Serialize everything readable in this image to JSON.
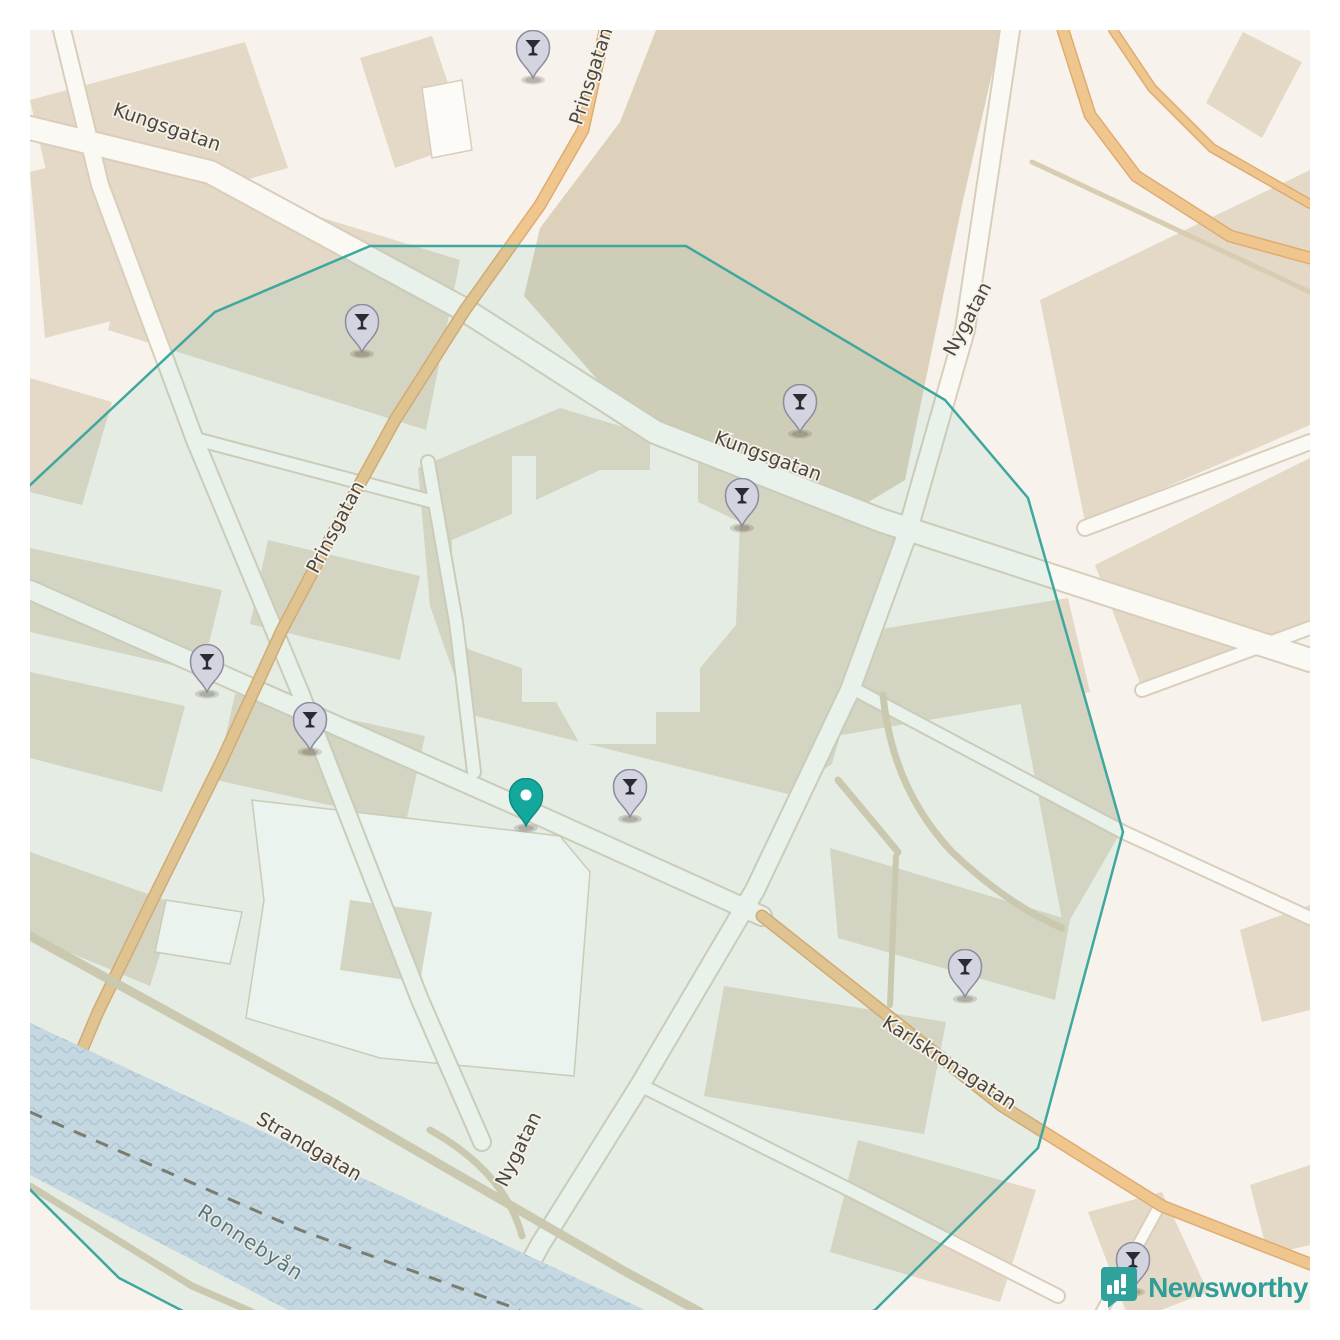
{
  "branding": {
    "logo_text": "Newsworthy",
    "logo_color": "#2f9e96",
    "logo_icon": "bar-chart-exclamation-badge"
  },
  "map": {
    "place": "Ronneby town centre",
    "street_labels": [
      {
        "text": "Kungsgatan",
        "x": 165,
        "y": 133,
        "rotation": 19,
        "kind": "street"
      },
      {
        "text": "Prinsgatan",
        "x": 597,
        "y": 78,
        "rotation": -72,
        "kind": "street"
      },
      {
        "text": "Prinsgatan",
        "x": 341,
        "y": 530,
        "rotation": -62,
        "kind": "street"
      },
      {
        "text": "Kungsgatan",
        "x": 766,
        "y": 462,
        "rotation": 20,
        "kind": "street"
      },
      {
        "text": "Nygatan",
        "x": 973,
        "y": 322,
        "rotation": -62,
        "kind": "street"
      },
      {
        "text": "Nygatan",
        "x": 524,
        "y": 1152,
        "rotation": -64,
        "kind": "street"
      },
      {
        "text": "Strandgatan",
        "x": 306,
        "y": 1152,
        "rotation": 30,
        "kind": "street"
      },
      {
        "text": "Karlskronagatan",
        "x": 946,
        "y": 1068,
        "rotation": 33,
        "kind": "street"
      },
      {
        "text": "Ronnebyån",
        "x": 247,
        "y": 1248,
        "rotation": 33,
        "kind": "water"
      }
    ],
    "markers": [
      {
        "type": "cocktail",
        "x": 533,
        "y": 78
      },
      {
        "type": "cocktail",
        "x": 362,
        "y": 352
      },
      {
        "type": "cocktail",
        "x": 800,
        "y": 432
      },
      {
        "type": "cocktail",
        "x": 742,
        "y": 526
      },
      {
        "type": "cocktail",
        "x": 207,
        "y": 692
      },
      {
        "type": "cocktail",
        "x": 310,
        "y": 750
      },
      {
        "type": "cocktail",
        "x": 630,
        "y": 817
      },
      {
        "type": "cocktail",
        "x": 965,
        "y": 997
      },
      {
        "type": "cocktail",
        "x": 1133,
        "y": 1290
      },
      {
        "type": "center",
        "x": 526,
        "y": 826
      }
    ],
    "marker_colors": {
      "cocktail_fill": "#d4d4e0",
      "cocktail_stroke": "#8c8c9e",
      "cocktail_glyph": "#2b2b33",
      "center_fill": "#14a79b",
      "center_stroke": "#0b8e84"
    },
    "area_polygon": {
      "points": "370,246 686,246 945,400 1028,498 1123,832 1038,1148 875,1310 700,1390 500,1405 300,1370 177,1308 119,1278 -40,1120 -90,840 -50,560 215,312",
      "stroke": "#3fa89e",
      "fill": "rgba(80,175,155,0.10)"
    },
    "water_name": "Ronnebyån"
  }
}
